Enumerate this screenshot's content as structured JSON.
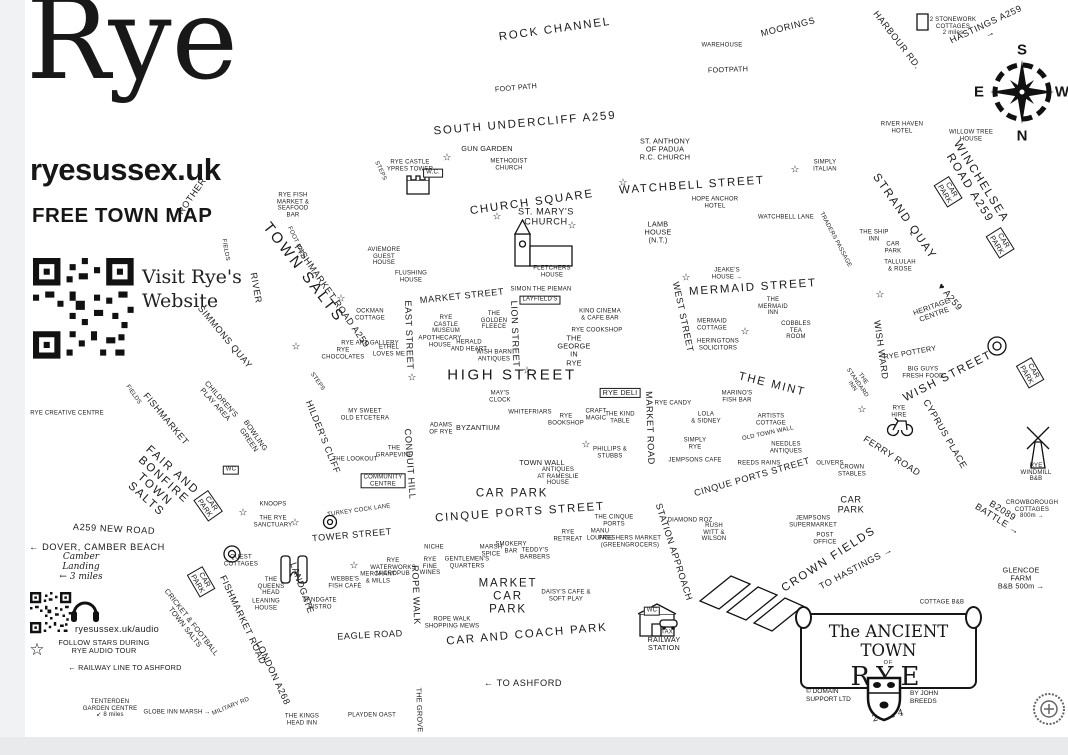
{
  "header": {
    "title": "Rye",
    "website": "ryesussex.uk",
    "tagline": "FREE TOWN MAP",
    "qr_caption_line1": "Visit Rye's",
    "qr_caption_line2": "Website"
  },
  "compass": {
    "top": "S",
    "left": "E",
    "right": "W",
    "bottom": "N"
  },
  "cartouche": {
    "line1": "The ANCIENT TOWN",
    "line2": "OF",
    "line3": "RYE",
    "publisher": "© DOMAIN\nSUPPORT LTD",
    "author": "BY JOHN\nBREEDS",
    "year": "2024"
  },
  "colors": {
    "ink": "#1b1b1b",
    "paper": "#ffffff",
    "chrome_strip": "#e8eaec"
  },
  "stars": [
    {
      "x": 447,
      "y": 158
    },
    {
      "x": 497,
      "y": 217
    },
    {
      "x": 572,
      "y": 226
    },
    {
      "x": 623,
      "y": 183
    },
    {
      "x": 795,
      "y": 170
    },
    {
      "x": 686,
      "y": 278
    },
    {
      "x": 745,
      "y": 332
    },
    {
      "x": 880,
      "y": 295
    },
    {
      "x": 296,
      "y": 347
    },
    {
      "x": 341,
      "y": 299
    },
    {
      "x": 412,
      "y": 378
    },
    {
      "x": 527,
      "y": 371
    },
    {
      "x": 586,
      "y": 445
    },
    {
      "x": 243,
      "y": 513
    },
    {
      "x": 295,
      "y": 523
    },
    {
      "x": 354,
      "y": 566
    },
    {
      "x": 862,
      "y": 410
    },
    {
      "x": 37,
      "y": 650,
      "size": 17
    }
  ],
  "labels": [
    {
      "t": "ROCK CHANNEL",
      "x": 555,
      "y": 30,
      "r": -8,
      "s": "l"
    },
    {
      "t": "MOORINGS",
      "x": 788,
      "y": 27,
      "r": -14,
      "s": "m"
    },
    {
      "t": "WAREHOUSE",
      "x": 722,
      "y": 46,
      "s": "xs"
    },
    {
      "t": "HARBOUR RD.",
      "x": 897,
      "y": 40,
      "r": 52,
      "s": "m"
    },
    {
      "t": "2 STONEWORK\nCOTTAGES\n2 miles",
      "x": 953,
      "y": 27,
      "s": "xs"
    },
    {
      "t": "HASTINGS A259 →",
      "x": 988,
      "y": 29,
      "r": -25,
      "s": "m"
    },
    {
      "t": "FOOT PATH",
      "x": 516,
      "y": 88,
      "r": -5,
      "s": "s"
    },
    {
      "t": "FOOTPATH",
      "x": 728,
      "y": 70,
      "r": -2,
      "s": "s"
    },
    {
      "t": "SOUTH UNDERCLIFF A259",
      "x": 525,
      "y": 124,
      "r": -5,
      "s": "l"
    },
    {
      "t": "RIVER HAVEN\nHOTEL",
      "x": 902,
      "y": 128,
      "s": "xs"
    },
    {
      "t": "WILLOW TREE\nHOUSE",
      "x": 971,
      "y": 136,
      "s": "xs"
    },
    {
      "t": "WINCHELSEA ROAD A259",
      "x": 975,
      "y": 185,
      "r": 58,
      "s": "l"
    },
    {
      "t": "CAR\nPARK",
      "x": 948,
      "y": 192,
      "r": 58,
      "s": "s",
      "b": 1
    },
    {
      "t": "CAR\nPARK",
      "x": 1000,
      "y": 243,
      "r": 58,
      "s": "s",
      "b": 1
    },
    {
      "t": "STRAND QUAY",
      "x": 904,
      "y": 217,
      "r": 55,
      "s": "l"
    },
    {
      "t": "SIMPLY\nITALIAN",
      "x": 825,
      "y": 166,
      "s": "xs"
    },
    {
      "t": "THE SHIP\nINN",
      "x": 874,
      "y": 236,
      "s": "xs"
    },
    {
      "t": "CAR\nPARK",
      "x": 893,
      "y": 248,
      "s": "xs"
    },
    {
      "t": "TALLULAH\n& ROSE",
      "x": 900,
      "y": 266,
      "s": "xs"
    },
    {
      "t": "HERITAGE\nCENTRE",
      "x": 933,
      "y": 311,
      "r": -20,
      "s": "s"
    },
    {
      "t": "♥ A259",
      "x": 950,
      "y": 297,
      "r": 50,
      "s": "m"
    },
    {
      "t": "GUN GARDEN",
      "x": 487,
      "y": 149,
      "s": "s"
    },
    {
      "t": "METHODIST\nCHURCH",
      "x": 509,
      "y": 165,
      "s": "xs"
    },
    {
      "t": "RYE CASTLE\nYPRES TOWER",
      "x": 410,
      "y": 166,
      "s": "xs"
    },
    {
      "t": "W.C.",
      "x": 433,
      "y": 173,
      "s": "xs",
      "b": 1
    },
    {
      "t": "STEPS",
      "x": 380,
      "y": 171,
      "r": 65,
      "s": "xs"
    },
    {
      "t": "ST. ANTHONY\nOF PADUA\nR.C. CHURCH",
      "x": 665,
      "y": 150,
      "s": "s"
    },
    {
      "t": "CHURCH SQUARE",
      "x": 532,
      "y": 203,
      "r": -8,
      "s": "l"
    },
    {
      "t": "ST. MARY'S\nCHURCH",
      "x": 546,
      "y": 217,
      "s": "m"
    },
    {
      "t": "WATCHBELL STREET",
      "x": 692,
      "y": 186,
      "r": -4,
      "s": "l"
    },
    {
      "t": "HOPE ANCHOR\nHOTEL",
      "x": 715,
      "y": 203,
      "s": "xs"
    },
    {
      "t": "WATCHBELL LANE",
      "x": 786,
      "y": 218,
      "s": "xs"
    },
    {
      "t": "TRADERS PASSAGE",
      "x": 835,
      "y": 240,
      "r": 62,
      "s": "xs"
    },
    {
      "t": "LAMB\nHOUSE\n(N.T.)",
      "x": 658,
      "y": 233,
      "s": "s"
    },
    {
      "t": "JEAKE'S\nHOUSE →",
      "x": 727,
      "y": 274,
      "s": "xs"
    },
    {
      "t": "MERMAID STREET",
      "x": 753,
      "y": 288,
      "r": -4,
      "s": "l"
    },
    {
      "t": "THE\nMERMAID\nINN",
      "x": 773,
      "y": 307,
      "s": "xs"
    },
    {
      "t": "MERMAID\nCOTTAGE",
      "x": 712,
      "y": 325,
      "s": "xs"
    },
    {
      "t": "HERINGTONS\nSOLICITORS",
      "x": 718,
      "y": 345,
      "s": "xs"
    },
    {
      "t": "COBBLES\nTEA\nROOM",
      "x": 796,
      "y": 331,
      "s": "xs"
    },
    {
      "t": "WEST STREET",
      "x": 683,
      "y": 317,
      "r": 78,
      "s": "m"
    },
    {
      "t": "FLUSHING\nHOUSE",
      "x": 411,
      "y": 277,
      "s": "xs"
    },
    {
      "t": "FLETCHERS\nHOUSE",
      "x": 552,
      "y": 272,
      "s": "xs"
    },
    {
      "t": "SIMON THE PIEMAN",
      "x": 541,
      "y": 290,
      "s": "xs"
    },
    {
      "t": "LAYFIELD'S",
      "x": 540,
      "y": 300,
      "s": "xs",
      "b": 1
    },
    {
      "t": "KINO CINEMA\n& CAFE BAR",
      "x": 600,
      "y": 315,
      "s": "xs"
    },
    {
      "t": "RYE COOKSHOP",
      "x": 597,
      "y": 331,
      "s": "xs"
    },
    {
      "t": "THE\nGEORGE\nIN\nRYE",
      "x": 574,
      "y": 351,
      "s": "s"
    },
    {
      "t": "MARKET STREET",
      "x": 462,
      "y": 296,
      "r": -6,
      "s": "m"
    },
    {
      "t": "EAST STREET",
      "x": 409,
      "y": 335,
      "r": 88,
      "s": "m"
    },
    {
      "t": "LION STREET",
      "x": 515,
      "y": 334,
      "r": 88,
      "s": "m"
    },
    {
      "t": "RYE\nCASTLE\nMUSEUM",
      "x": 446,
      "y": 325,
      "s": "xs"
    },
    {
      "t": "THE\nGOLDEN\nFLEECE",
      "x": 494,
      "y": 321,
      "s": "xs"
    },
    {
      "t": "APOTHECARY\nHOUSE",
      "x": 440,
      "y": 342,
      "s": "xs"
    },
    {
      "t": "HERALD\nAND HEART",
      "x": 469,
      "y": 346,
      "s": "xs"
    },
    {
      "t": "WISH BARN\nANTIQUES",
      "x": 494,
      "y": 356,
      "s": "xs"
    },
    {
      "t": "OCKMAN\nCOTTAGE",
      "x": 370,
      "y": 315,
      "s": "xs"
    },
    {
      "t": "RYE ART GALLERY",
      "x": 370,
      "y": 344,
      "s": "xs"
    },
    {
      "t": "RYE\nCHOCOLATES",
      "x": 343,
      "y": 354,
      "s": "xs"
    },
    {
      "t": "ETHEL\nLOVES ME",
      "x": 389,
      "y": 351,
      "s": "xs"
    },
    {
      "t": "AVIEMORE\nGUEST\nHOUSE",
      "x": 384,
      "y": 257,
      "s": "xs"
    },
    {
      "t": "HIGH STREET",
      "x": 512,
      "y": 376,
      "s": "xl"
    },
    {
      "t": "RYE DELI",
      "x": 620,
      "y": 393,
      "s": "s",
      "b": 1
    },
    {
      "t": "WHITEFRIARS",
      "x": 530,
      "y": 413,
      "s": "xs"
    },
    {
      "t": "RYE\nBOOKSHOP",
      "x": 566,
      "y": 420,
      "s": "xs"
    },
    {
      "t": "CRAFT\nMAGIC",
      "x": 596,
      "y": 415,
      "s": "xs"
    },
    {
      "t": "THE KIND\nTABLE",
      "x": 620,
      "y": 418,
      "s": "xs"
    },
    {
      "t": "BYZANTIUM",
      "x": 478,
      "y": 428,
      "s": "s"
    },
    {
      "t": "ADAMS\nOF RYE",
      "x": 441,
      "y": 429,
      "s": "xs"
    },
    {
      "t": "MAY'S\nCLOCK",
      "x": 500,
      "y": 397,
      "s": "xs"
    },
    {
      "t": "MY SWEET\nOLD ETCETERA",
      "x": 365,
      "y": 415,
      "s": "xs"
    },
    {
      "t": "THE MINT",
      "x": 772,
      "y": 385,
      "r": 14,
      "s": "l"
    },
    {
      "t": "RYE CANDY",
      "x": 673,
      "y": 404,
      "s": "xs"
    },
    {
      "t": "LOLA\n& SIDNEY",
      "x": 706,
      "y": 418,
      "s": "xs"
    },
    {
      "t": "MARINO'S\nFISH BAR",
      "x": 737,
      "y": 397,
      "s": "xs"
    },
    {
      "t": "ARTISTS\nCOTTAGE",
      "x": 771,
      "y": 420,
      "s": "xs"
    },
    {
      "t": "THE\nSTANDARD\nINN",
      "x": 857,
      "y": 383,
      "r": 55,
      "s": "xs"
    },
    {
      "t": "WISH WARD",
      "x": 881,
      "y": 350,
      "r": 82,
      "s": "m"
    },
    {
      "t": "RYE POTTERY",
      "x": 910,
      "y": 353,
      "r": -10,
      "s": "s"
    },
    {
      "t": "BIG GUYS\nFRESH FOOD",
      "x": 923,
      "y": 373,
      "s": "xs"
    },
    {
      "t": "WISH STREET",
      "x": 948,
      "y": 377,
      "r": -27,
      "s": "l"
    },
    {
      "t": "CAR\nPARK",
      "x": 1030,
      "y": 373,
      "r": 60,
      "s": "s",
      "b": 1
    },
    {
      "t": "CYPRUS PLACE",
      "x": 945,
      "y": 434,
      "r": 60,
      "s": "m"
    },
    {
      "t": "RYE\nHIRE",
      "x": 899,
      "y": 412,
      "s": "xs"
    },
    {
      "t": "FERRY ROAD",
      "x": 892,
      "y": 456,
      "r": 33,
      "s": "m"
    },
    {
      "t": "RYE\nWINDMILL\nB&B",
      "x": 1036,
      "y": 473,
      "s": "xs"
    },
    {
      "t": "CROWBOROUGH\nCOTTAGES\n800m →",
      "x": 1032,
      "y": 510,
      "s": "xs"
    },
    {
      "t": "B2089 BATTLE →",
      "x": 1000,
      "y": 515,
      "r": 32,
      "s": "m"
    },
    {
      "t": "GLENCOE FARM\nB&B 500m →",
      "x": 1021,
      "y": 579,
      "s": "s"
    },
    {
      "t": "COTTAGE B&B",
      "x": 942,
      "y": 603,
      "s": "xs"
    },
    {
      "t": "OLD TOWN WALL",
      "x": 768,
      "y": 434,
      "r": -12,
      "s": "xs"
    },
    {
      "t": "NEEDLES\nANTIQUES",
      "x": 786,
      "y": 448,
      "s": "xs"
    },
    {
      "t": "SIMPLY\nRYE",
      "x": 695,
      "y": 444,
      "s": "xs"
    },
    {
      "t": "JEMPSONS CAFE",
      "x": 695,
      "y": 461,
      "s": "xs"
    },
    {
      "t": "REEDS RAINS",
      "x": 759,
      "y": 464,
      "s": "xs"
    },
    {
      "t": "CINQUE PORTS STREET",
      "x": 752,
      "y": 477,
      "r": -16,
      "s": "m"
    },
    {
      "t": "OLIVERS",
      "x": 830,
      "y": 464,
      "s": "xs"
    },
    {
      "t": "CROWN\nSTABLES",
      "x": 852,
      "y": 471,
      "s": "xs"
    },
    {
      "t": "PHILLIPS &\nSTUBBS",
      "x": 610,
      "y": 453,
      "s": "xs"
    },
    {
      "t": "TOWN WALL",
      "x": 542,
      "y": 463,
      "s": "s"
    },
    {
      "t": "ANTIQUES\nAT RAMESLIE\nHOUSE",
      "x": 558,
      "y": 477,
      "s": "xs"
    },
    {
      "t": "CAR PARK",
      "x": 512,
      "y": 494,
      "s": "l"
    },
    {
      "t": "CINQUE PORTS STREET",
      "x": 520,
      "y": 513,
      "r": -4,
      "s": "l"
    },
    {
      "t": "MARKET ROAD",
      "x": 650,
      "y": 428,
      "r": 88,
      "s": "m"
    },
    {
      "t": "STATION APPROACH",
      "x": 674,
      "y": 552,
      "r": 72,
      "s": "m"
    },
    {
      "t": "RUSH\nWITT &\nWILSON",
      "x": 714,
      "y": 533,
      "s": "xs"
    },
    {
      "t": "DIAMOND ROZ",
      "x": 690,
      "y": 521,
      "s": "xs"
    },
    {
      "t": "JEMPSONS\nSUPERMARKET",
      "x": 813,
      "y": 522,
      "s": "xs"
    },
    {
      "t": "POST\nOFFICE",
      "x": 825,
      "y": 539,
      "s": "xs"
    },
    {
      "t": "CROWN FIELDS",
      "x": 829,
      "y": 560,
      "r": -33,
      "s": "l"
    },
    {
      "t": "TO HASTINGS →",
      "x": 856,
      "y": 568,
      "r": -28,
      "s": "m"
    },
    {
      "t": "CAR\nPARK",
      "x": 851,
      "y": 505,
      "s": "m"
    },
    {
      "t": "TOWER STREET",
      "x": 352,
      "y": 535,
      "r": -5,
      "s": "m"
    },
    {
      "t": "TURKEY COCK LANE",
      "x": 359,
      "y": 511,
      "r": -8,
      "s": "xs"
    },
    {
      "t": "HILDER'S CLIFF",
      "x": 323,
      "y": 437,
      "r": 68,
      "s": "m"
    },
    {
      "t": "THE LOOKOUT",
      "x": 355,
      "y": 460,
      "s": "xs"
    },
    {
      "t": "THE\nGRAPEVINE",
      "x": 394,
      "y": 452,
      "s": "xs"
    },
    {
      "t": "COMMUNITY\nCENTRE",
      "x": 383,
      "y": 481,
      "s": "xs",
      "b": 1
    },
    {
      "t": "CONDUIT HILL",
      "x": 410,
      "y": 464,
      "r": 86,
      "s": "m"
    },
    {
      "t": "ROPE WALK",
      "x": 416,
      "y": 595,
      "r": 88,
      "s": "m"
    },
    {
      "t": "WEBBE'S\nFISH CAFÉ",
      "x": 345,
      "y": 583,
      "s": "xs"
    },
    {
      "t": "MERCHANT\n& MILLS",
      "x": 378,
      "y": 578,
      "s": "xs"
    },
    {
      "t": "RYE\nWATERWORKS\nMICROPUB",
      "x": 393,
      "y": 568,
      "s": "xs"
    },
    {
      "t": "NICHE",
      "x": 434,
      "y": 548,
      "s": "xs"
    },
    {
      "t": "RYE\nFINE\nWINES",
      "x": 430,
      "y": 567,
      "s": "xs"
    },
    {
      "t": "GENTLEMEN'S\nQUARTERS",
      "x": 467,
      "y": 563,
      "s": "xs"
    },
    {
      "t": "MARSH\nSPICE",
      "x": 491,
      "y": 551,
      "s": "xs"
    },
    {
      "t": "SMOKERY\nBAR",
      "x": 511,
      "y": 548,
      "s": "xs"
    },
    {
      "t": "TEDDY'S\nBARBERS",
      "x": 535,
      "y": 554,
      "s": "xs"
    },
    {
      "t": "RYE\nRETREAT",
      "x": 568,
      "y": 536,
      "s": "xs"
    },
    {
      "t": "MANU\nLOUNGE",
      "x": 600,
      "y": 535,
      "s": "xs"
    },
    {
      "t": "FRESHERS MARKET\n(GREENGROCERS)",
      "x": 630,
      "y": 542,
      "s": "xs"
    },
    {
      "t": "THE CINQUE\nPORTS",
      "x": 614,
      "y": 521,
      "s": "xs"
    },
    {
      "t": "MARKET\nCAR\nPARK",
      "x": 508,
      "y": 597,
      "s": "l"
    },
    {
      "t": "DAISY'S CAFE &\nSOFT PLAY",
      "x": 566,
      "y": 596,
      "s": "xs"
    },
    {
      "t": "CAR AND COACH PARK",
      "x": 527,
      "y": 635,
      "r": -5,
      "s": "l"
    },
    {
      "t": "EAGLE ROAD",
      "x": 370,
      "y": 635,
      "r": -3,
      "s": "m"
    },
    {
      "t": "ROPE WALK\nSHOPPING MEWS",
      "x": 452,
      "y": 623,
      "s": "xs"
    },
    {
      "t": "LANDGATE",
      "x": 302,
      "y": 588,
      "r": 70,
      "s": "m"
    },
    {
      "t": "LANDGATE\nBISTRO",
      "x": 320,
      "y": 604,
      "s": "xs"
    },
    {
      "t": "LONDON A268",
      "x": 273,
      "y": 673,
      "r": 65,
      "s": "m"
    },
    {
      "t": "THE KINGS\nHEAD INN",
      "x": 302,
      "y": 720,
      "s": "xs"
    },
    {
      "t": "PLAYDEN OAST",
      "x": 372,
      "y": 716,
      "s": "xs"
    },
    {
      "t": "THE GROVE",
      "x": 419,
      "y": 710,
      "r": 88,
      "s": "s"
    },
    {
      "t": "← TO ASHFORD",
      "x": 523,
      "y": 683,
      "s": "m"
    },
    {
      "t": "MILITARY RD",
      "x": 231,
      "y": 707,
      "r": -22,
      "s": "xs"
    },
    {
      "t": "← RAILWAY LINE TO ASHFORD",
      "x": 125,
      "y": 668,
      "s": "s"
    },
    {
      "t": "TENTERDEN\nGARDEN CENTRE\n↙ 8 miles",
      "x": 110,
      "y": 709,
      "s": "xs"
    },
    {
      "t": "GLOBE INN MARSH →",
      "x": 177,
      "y": 713,
      "s": "xs"
    },
    {
      "t": "RAILWAY\nSTATION",
      "x": 664,
      "y": 644,
      "s": "s"
    },
    {
      "t": "WC",
      "x": 652,
      "y": 611,
      "s": "xs",
      "b": 1
    },
    {
      "t": "TAXI",
      "x": 668,
      "y": 633,
      "s": "xs"
    },
    {
      "t": "FAIR AND\nBONFIRE\nTOWN\nSALTS",
      "x": 159,
      "y": 485,
      "r": 42,
      "s": "l"
    },
    {
      "t": "CAR\nPARK",
      "x": 208,
      "y": 506,
      "r": 55,
      "s": "s",
      "b": 1
    },
    {
      "t": "WC",
      "x": 231,
      "y": 470,
      "s": "xs",
      "b": 1
    },
    {
      "t": "BOWLING\nGREEN",
      "x": 252,
      "y": 438,
      "r": 55,
      "s": "s"
    },
    {
      "t": "CHILDREN'S\nPLAY AREA",
      "x": 218,
      "y": 402,
      "r": 48,
      "s": "s"
    },
    {
      "t": "FISHMARKET",
      "x": 166,
      "y": 419,
      "r": 50,
      "s": "m"
    },
    {
      "t": "FIELDS",
      "x": 133,
      "y": 395,
      "r": 55,
      "s": "xs"
    },
    {
      "t": "FIELDS",
      "x": 225,
      "y": 250,
      "r": 80,
      "s": "xs"
    },
    {
      "t": "RIVER",
      "x": 256,
      "y": 288,
      "r": 80,
      "s": "m"
    },
    {
      "t": "ROTHER",
      "x": 192,
      "y": 196,
      "r": -55,
      "s": "m"
    },
    {
      "t": "SIMMONS QUAY",
      "x": 225,
      "y": 337,
      "r": 50,
      "s": "m"
    },
    {
      "t": "TOWN SALTS",
      "x": 303,
      "y": 273,
      "r": 52,
      "s": "xl"
    },
    {
      "t": "FOOT PATH",
      "x": 296,
      "y": 243,
      "r": 65,
      "s": "xs"
    },
    {
      "t": "FISHMARKET ROAD A259",
      "x": 332,
      "y": 296,
      "r": 55,
      "s": "m"
    },
    {
      "t": "STEPS",
      "x": 317,
      "y": 382,
      "r": 55,
      "s": "xs"
    },
    {
      "t": "RYE FISH\nMARKET &\nSEAFOOD\nBAR",
      "x": 293,
      "y": 206,
      "s": "xs"
    },
    {
      "t": "RYE CREATIVE CENTRE",
      "x": 67,
      "y": 414,
      "s": "xs"
    },
    {
      "t": "A259 NEW ROAD",
      "x": 114,
      "y": 529,
      "r": 3,
      "s": "m"
    },
    {
      "t": "← DOVER, CAMBER BEACH",
      "x": 97,
      "y": 547,
      "s": "m"
    },
    {
      "t": "Camber\nLanding\n← 3 miles",
      "x": 81,
      "y": 567,
      "s": "s",
      "f": "script"
    },
    {
      "t": "CRICKET & FOOTBALL\nTOWN SALTS",
      "x": 188,
      "y": 625,
      "r": 52,
      "s": "s"
    },
    {
      "t": "CAR\nPARK",
      "x": 201,
      "y": 582,
      "r": 60,
      "s": "s",
      "b": 1
    },
    {
      "t": "FISHMARKET ROAD",
      "x": 243,
      "y": 620,
      "r": 65,
      "s": "m"
    },
    {
      "t": "QUEST\nCOTTAGES",
      "x": 241,
      "y": 561,
      "s": "xs"
    },
    {
      "t": "KNOOPS",
      "x": 273,
      "y": 505,
      "s": "xs"
    },
    {
      "t": "THE RYE\nSANCTUARY",
      "x": 273,
      "y": 522,
      "s": "xs"
    },
    {
      "t": "THE\nQUEENS\nHEAD",
      "x": 271,
      "y": 587,
      "s": "xs"
    },
    {
      "t": "LEANING\nHOUSE",
      "x": 266,
      "y": 605,
      "s": "xs"
    },
    {
      "t": "ryesussex.uk/audio",
      "x": 117,
      "y": 629,
      "s": "m",
      "f": "lower"
    },
    {
      "t": "FOLLOW STARS DURING\nRYE AUDIO TOUR",
      "x": 104,
      "y": 647,
      "s": "s"
    }
  ]
}
